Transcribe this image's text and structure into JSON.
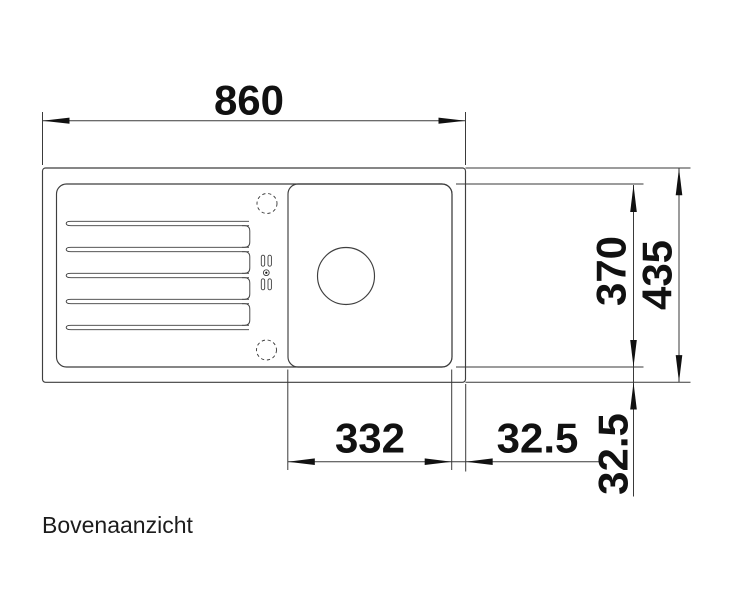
{
  "drawing": {
    "caption": "Bovenaanzicht",
    "dims": {
      "width_total": "860",
      "depth_inner": "370",
      "depth_total": "435",
      "bowl_width": "332",
      "bowl_offset_right": "32.5",
      "depth_offset_bottom": "32.5"
    },
    "colors": {
      "line": "#3f3f3f",
      "dim": "#3a3a3a",
      "ink": "#111111",
      "bg": "#ffffff"
    }
  }
}
